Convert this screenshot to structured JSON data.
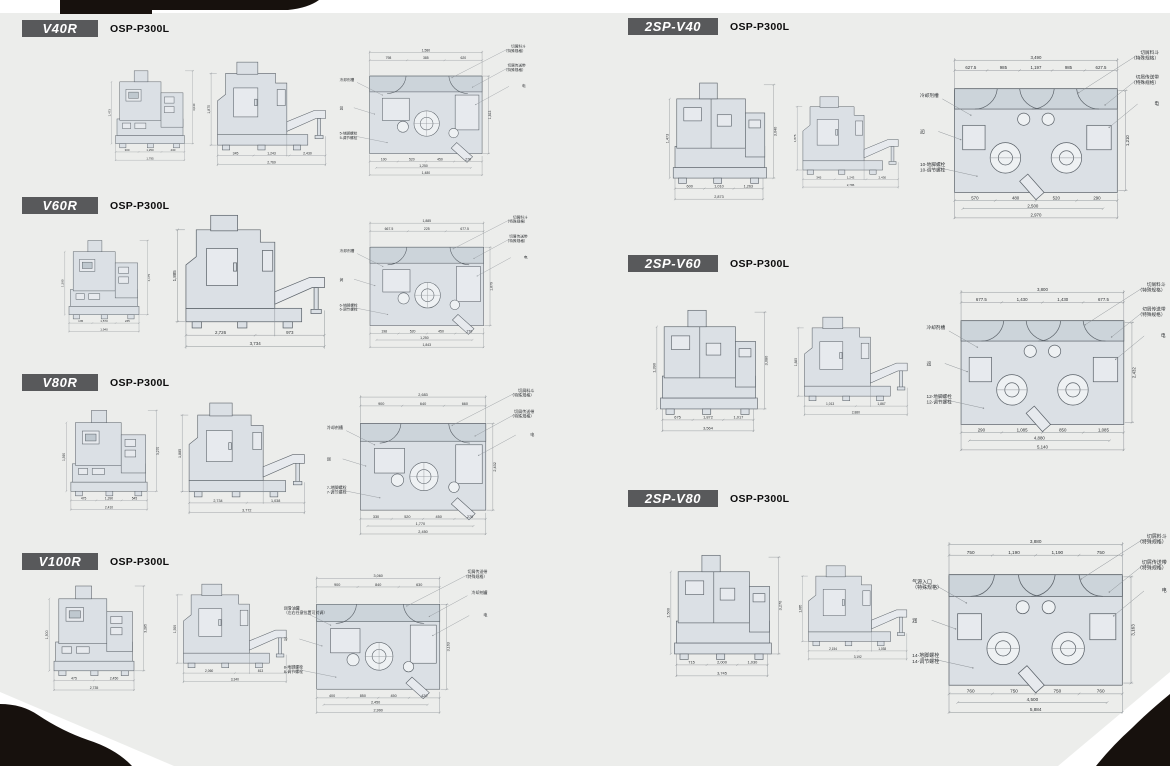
{
  "page": {
    "bg": "#ecedeb",
    "paper_white": "#ffffff",
    "ink": "#17110d",
    "badge_bg": "#58595b",
    "badge_fg": "#ffffff",
    "drawing_fill": "#dbe0e5",
    "drawing_fill_light": "#e7eaee",
    "drawing_band": "#ccd4da",
    "line": "#5c636a",
    "dim_line": "#8b9095",
    "text_color": "#2e3134"
  },
  "sections": [
    {
      "id": "v40r",
      "model": "V40R",
      "control": "OSP-P300L",
      "twin": false,
      "front": {
        "seg": [
          "300",
          "1,250",
          "430"
        ],
        "total": "1,795",
        "height": "3,040",
        "height2": "1,473"
      },
      "side": {
        "seg": [
          "345",
          "1,243",
          "2,430"
        ],
        "total": "2,769",
        "height": "1,875"
      },
      "plan": {
        "top_total": "1,580",
        "top_seg": [
          "798",
          "385",
          "620"
        ],
        "right": "1,813",
        "bot_seg": [
          "100",
          "520",
          "450",
          "270"
        ],
        "bot_mid": "1,250",
        "bot_total": "1,480",
        "callouts": {
          "lt": [
            "冷却剂槽"
          ],
          "lm": "润滑单元",
          "lb": [
            "5-地脚螺栓",
            "5-调节螺栓"
          ],
          "tr": [
            "切屑料斗",
            "（特殊规格）"
          ],
          "rt": [
            "切屑传送带",
            "（特殊规格）"
          ],
          "rm": "电源入口"
        }
      }
    },
    {
      "id": "v60r",
      "model": "V60R",
      "control": "OSP-P300L",
      "twin": false,
      "front": {
        "seg": [
          "135",
          "1,570",
          "235"
        ],
        "total": "1,940",
        "height": "3,175",
        "height2": "1,390"
      },
      "side": {
        "seg": [
          "2,726",
          "973"
        ],
        "total": "3,734",
        "height": "1,885"
      },
      "plan": {
        "top_total": "1,885",
        "top_seg": [
          "667.5",
          "225",
          "677.5"
        ],
        "right": "1,879",
        "bot_seg": [
          "198",
          "520",
          "450",
          "270"
        ],
        "bot_mid": "1,250",
        "bot_total": "1,843",
        "callouts": {
          "lt": [
            "冷却剂槽"
          ],
          "lm": "润滑单元",
          "lb": [
            "6-地脚螺栓",
            "6-调节螺栓"
          ],
          "tr": [
            "切屑料斗",
            "（特殊规格）"
          ],
          "rt": [
            "切屑传送带",
            "（特殊规格）"
          ],
          "rm": "电源入口"
        }
      }
    },
    {
      "id": "v80r",
      "model": "V80R",
      "control": "OSP-P300L",
      "twin": false,
      "front": {
        "seg": [
          "475",
          "1,390",
          "545"
        ],
        "total": "2,410",
        "height": "3,270",
        "height2": "1,390"
      },
      "side": {
        "seg": [
          "2,734",
          "1,038"
        ],
        "total": "3,772",
        "height": "1,885"
      },
      "plan": {
        "top_total": "2,683",
        "top_seg": [
          "900",
          "640",
          "660"
        ],
        "right": "2,432",
        "bot_seg": [
          "330",
          "520",
          "450",
          "270"
        ],
        "bot_mid": "1,770",
        "bot_total": "2,450",
        "callouts": {
          "lt": [
            "冷却剂槽"
          ],
          "lm": "润滑单元",
          "lb": [
            "7-地脚螺栓",
            "7-调节螺栓"
          ],
          "tr": [
            "切屑料斗",
            "（特殊规格）"
          ],
          "rt": [
            "切屑传送带",
            "（特殊规格）"
          ],
          "rm": "电源入口"
        }
      }
    },
    {
      "id": "v100r",
      "model": "V100R",
      "control": "OSP-P300L",
      "twin": false,
      "front": {
        "seg": [
          "475",
          "2,450"
        ],
        "total": "2,735",
        "height": "3,285",
        "height2": "1,500"
      },
      "side": {
        "seg": [
          "2,060",
          "813"
        ],
        "total": "3,340",
        "height": "1,500"
      },
      "plan": {
        "top_total": "3,060",
        "top_seg": [
          "900",
          "840",
          "630"
        ],
        "right": "3,163",
        "bot_seg": [
          "400",
          "850",
          "450",
          "420"
        ],
        "bot_mid": "2,450",
        "bot_total": "2,990",
        "callouts": {
          "lt": [
            "润滑油罐",
            "（左右任意位置可对调）"
          ],
          "lm": "冷却剂罐",
          "lb": [
            "8-地脚螺栓",
            "8-调节螺栓"
          ],
          "tr": [
            "切屑传送带",
            "（特殊规格）"
          ],
          "rt": [
            "冷却剂罐"
          ],
          "rm": "电源入口"
        }
      }
    },
    {
      "id": "2sp-v40",
      "model": "2SP-V40",
      "control": "OSP-P300L",
      "twin": true,
      "front": {
        "seg": [
          "600",
          "1,010",
          "1,263"
        ],
        "total": "2,873",
        "height": "3,040",
        "height2": "1,473"
      },
      "side": {
        "seg": [
          "345",
          "1,243",
          "2,430"
        ],
        "total": "2,786",
        "height": "1,875"
      },
      "plan": {
        "top_total": "3,490",
        "top_seg": [
          "627.5",
          "985",
          "1,197",
          "985",
          "627.5"
        ],
        "right": "1,210",
        "bot_seg": [
          "570",
          "480",
          "520",
          "290"
        ],
        "bot_mid": "2,500",
        "bot_total": "2,970",
        "callouts": {
          "lt": [
            "冷却剂槽"
          ],
          "lm": "润滑单元",
          "lb": [
            "10-地脚螺栓",
            "10-调节螺栓"
          ],
          "tr": [
            "切屑料斗",
            "（特殊规格）"
          ],
          "rt": [
            "切屑传送带",
            "（特殊规格）"
          ],
          "rm": "电源入口"
        }
      }
    },
    {
      "id": "2sp-v60",
      "model": "2SP-V60",
      "control": "OSP-P300L",
      "twin": true,
      "front": {
        "seg": [
          "675",
          "1,872",
          "1,017"
        ],
        "total": "3,564",
        "height": "3,080",
        "height2": "1,390"
      },
      "side": {
        "seg": [
          "1,013",
          "1,867"
        ],
        "total": "2,880",
        "height": "1,885"
      },
      "plan": {
        "top_total": "3,800",
        "top_seg": [
          "677.5",
          "1,430",
          "1,430",
          "677.5"
        ],
        "right": "2,432",
        "bot_seg": [
          "290",
          "1,085",
          "850",
          "1,085"
        ],
        "bot_mid": "4,880",
        "bot_total": "5,140",
        "callouts": {
          "lt": [
            "冷却剂槽"
          ],
          "lm": "润滑单元",
          "lb": [
            "12-地脚螺栓",
            "12-调节螺栓"
          ],
          "tr": [
            "切屑料斗",
            "（特殊规格）"
          ],
          "rt": [
            "切屑传送带",
            "（特殊规格）"
          ],
          "rm": "电源入口"
        }
      }
    },
    {
      "id": "2sp-v80",
      "model": "2SP-V80",
      "control": "OSP-P300L",
      "twin": true,
      "front": {
        "seg": [
          "715",
          "2,000",
          "1,030"
        ],
        "total": "3,745",
        "height": "3,270",
        "height2": "1,500"
      },
      "side": {
        "seg": [
          "2,154",
          "1,038"
        ],
        "total": "3,192",
        "height": "1,885"
      },
      "plan": {
        "top_total": "3,880",
        "top_seg": [
          "750",
          "1,190",
          "1,190",
          "750"
        ],
        "right": "3,163",
        "bot_seg": [
          "760",
          "750",
          "750",
          "760"
        ],
        "bot_mid": "4,500",
        "bot_total": "5,884",
        "callouts": {
          "lt": [
            "气源入口",
            "（特殊规格）"
          ],
          "lm": "润滑单元",
          "lb": [
            "14-地脚螺栓",
            "14-调节螺栓"
          ],
          "tr": [
            "切屑料斗",
            "（特殊规格）"
          ],
          "rt": [
            "切屑传送带",
            "（特殊规格）"
          ],
          "rm": "电源入口"
        }
      }
    }
  ]
}
